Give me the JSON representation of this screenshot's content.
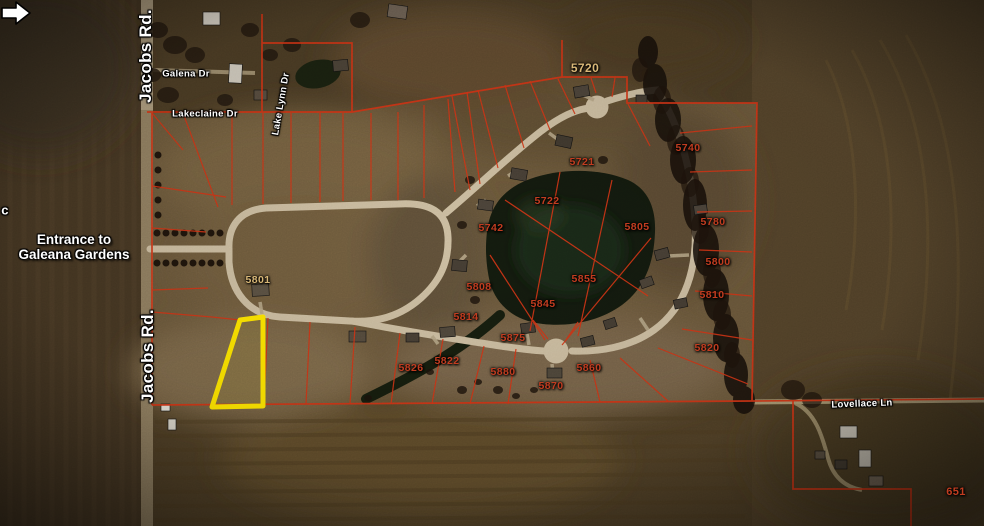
{
  "map": {
    "entrance": {
      "line1": "Entrance to",
      "line2": "Galeana Gardens"
    },
    "street_labels": [
      {
        "text": "Jacobs Rd.",
        "x": 146,
        "y": 56,
        "rotate": -90,
        "size": 17
      },
      {
        "text": "Jacobs Rd.",
        "x": 148,
        "y": 356,
        "rotate": -90,
        "size": 17
      },
      {
        "text": "Galena Dr",
        "x": 186,
        "y": 74,
        "rotate": 0,
        "size": 9.5
      },
      {
        "text": "Lakeclaine Dr",
        "x": 205,
        "y": 114,
        "rotate": 0,
        "size": 9.5
      },
      {
        "text": "Lake Lynn Dr",
        "x": 281,
        "y": 104,
        "rotate": -80,
        "size": 9.5
      },
      {
        "text": "Lovellace Ln",
        "x": 862,
        "y": 404,
        "rotate": -2,
        "size": 9.5
      },
      {
        "text": "c",
        "x": 5,
        "y": 210,
        "rotate": 0,
        "size": 13
      }
    ],
    "lot_labels": [
      {
        "text": "5720",
        "x": 585,
        "y": 68,
        "color": "#d9b878",
        "size": 12
      },
      {
        "text": "5801",
        "x": 258,
        "y": 280,
        "color": "#d9b878"
      },
      {
        "text": "5740",
        "x": 688,
        "y": 148
      },
      {
        "text": "5721",
        "x": 582,
        "y": 162
      },
      {
        "text": "5722",
        "x": 547,
        "y": 201
      },
      {
        "text": "5780",
        "x": 713,
        "y": 222
      },
      {
        "text": "5742",
        "x": 491,
        "y": 228
      },
      {
        "text": "5805",
        "x": 637,
        "y": 227
      },
      {
        "text": "5800",
        "x": 718,
        "y": 262
      },
      {
        "text": "5855",
        "x": 584,
        "y": 279
      },
      {
        "text": "5808",
        "x": 479,
        "y": 287
      },
      {
        "text": "5810",
        "x": 712,
        "y": 295
      },
      {
        "text": "5845",
        "x": 543,
        "y": 304
      },
      {
        "text": "5814",
        "x": 466,
        "y": 317
      },
      {
        "text": "5875",
        "x": 513,
        "y": 338
      },
      {
        "text": "5820",
        "x": 707,
        "y": 348
      },
      {
        "text": "5822",
        "x": 447,
        "y": 361
      },
      {
        "text": "5826",
        "x": 411,
        "y": 368
      },
      {
        "text": "5860",
        "x": 589,
        "y": 368
      },
      {
        "text": "5880",
        "x": 503,
        "y": 372
      },
      {
        "text": "5870",
        "x": 551,
        "y": 386
      },
      {
        "text": "651",
        "x": 956,
        "y": 492,
        "size": 11
      }
    ],
    "colors": {
      "parcel_line": "#d13415",
      "highlight_lot": "#ffe600",
      "lot_text": "#c23d20",
      "lot_text_alt": "#d9b878",
      "street_text": "#ffffff"
    }
  }
}
